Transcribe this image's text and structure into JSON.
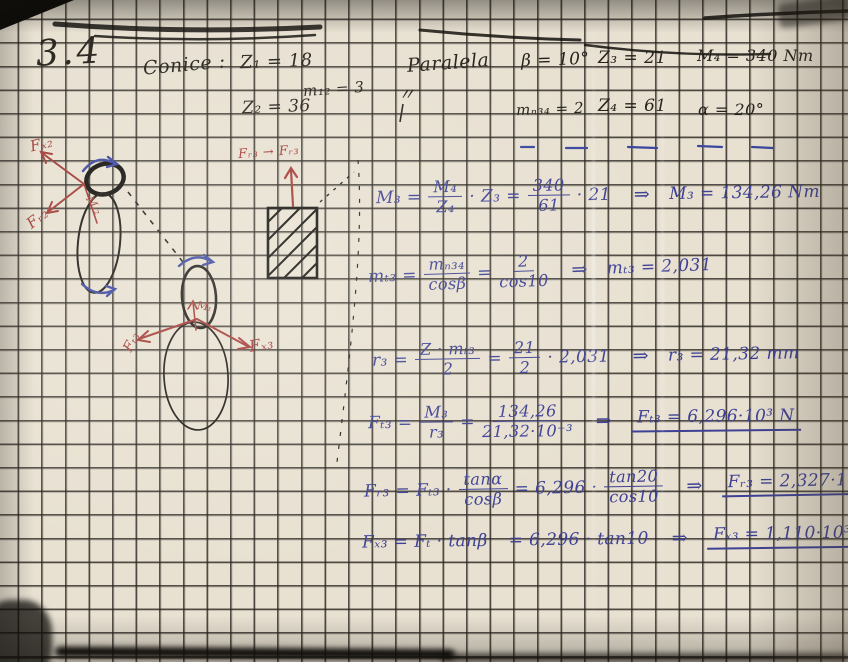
{
  "colors": {
    "paper": "#e8e1d2",
    "grid_line": "#2a261e",
    "blue_ink": "#3e4194",
    "red_ink": "#a23a35",
    "black_ink": "#26221c"
  },
  "header": {
    "section_number": "3.4",
    "gear_type_label": "Conice :",
    "z1": "Z₁ = 18",
    "m12": "m₁₂ = 3",
    "z2": "Z₂ = 36",
    "ditto_mark": "〃",
    "parallel_label": "Paralela",
    "beta": "β = 10°",
    "z3": "Z₃ = 21",
    "m4": "M₄ = 340 Nm",
    "mn34": "mₙ₃₄ = 2",
    "z4": "Z₄ = 61",
    "alpha": "α = 20°"
  },
  "diagram_labels": {
    "fx2": "Fₓ₂",
    "fr2": "Fᵣ₂",
    "mt2": "Mₜ₂",
    "fr3_wall": "Fᵣ₃ → Fᵣ₃",
    "ft3": "Fₜ₃",
    "fx3": "Fₓ₃",
    "mt3": "Mₜ"
  },
  "equations": [
    {
      "lhs": "M₃ =",
      "f1n": "M₄",
      "f1d": "Z₄",
      "t1": "· Z₃  =",
      "f2n": "340",
      "f2d": "61",
      "t2": "· 21",
      "arrow": "⇒",
      "result": "M₃ = 134,26 Nm"
    },
    {
      "lhs": "mₜ₃ =",
      "f1n": "mₙ₃₄",
      "f1d": "cosβ",
      "t1": "=",
      "f2n": "2",
      "f2d": "cos10",
      "arrow": "⇒",
      "result": "mₜ₃ = 2,031"
    },
    {
      "lhs": "r₃ =",
      "f1n": "Z · mₜ₃",
      "f1d": "2",
      "t1": "=",
      "f2n": "21",
      "f2d": "2",
      "t2": "· 2,031",
      "arrow": "⇒",
      "result": "r₃ = 21,32 mm"
    },
    {
      "lhs": "Fₜ₃ =",
      "f1n": "M₃",
      "f1d": "r₃",
      "t1": "=",
      "f2n": "134,26",
      "f2d": "21,32·10⁻³",
      "arrow": "⇒",
      "result": "Fₜ₃ = 6,296·10³ N"
    },
    {
      "lhs": "Fᵣ₃ = Fₜ₃ ·",
      "f1n": "tanα",
      "f1d": "cosβ",
      "t1": "= 6,296 ·",
      "f2n": "tan20",
      "f2d": "cos10",
      "arrow": "⇒",
      "result": "Fᵣ₃ = 2,327·10³ N"
    },
    {
      "lhs": "Fₓ₃ = Fₜ · tanβ",
      "t1": "= 6,296 · tan10",
      "arrow": "⇒",
      "result": "Fₓ₃ = 1,110·10³ N"
    }
  ]
}
